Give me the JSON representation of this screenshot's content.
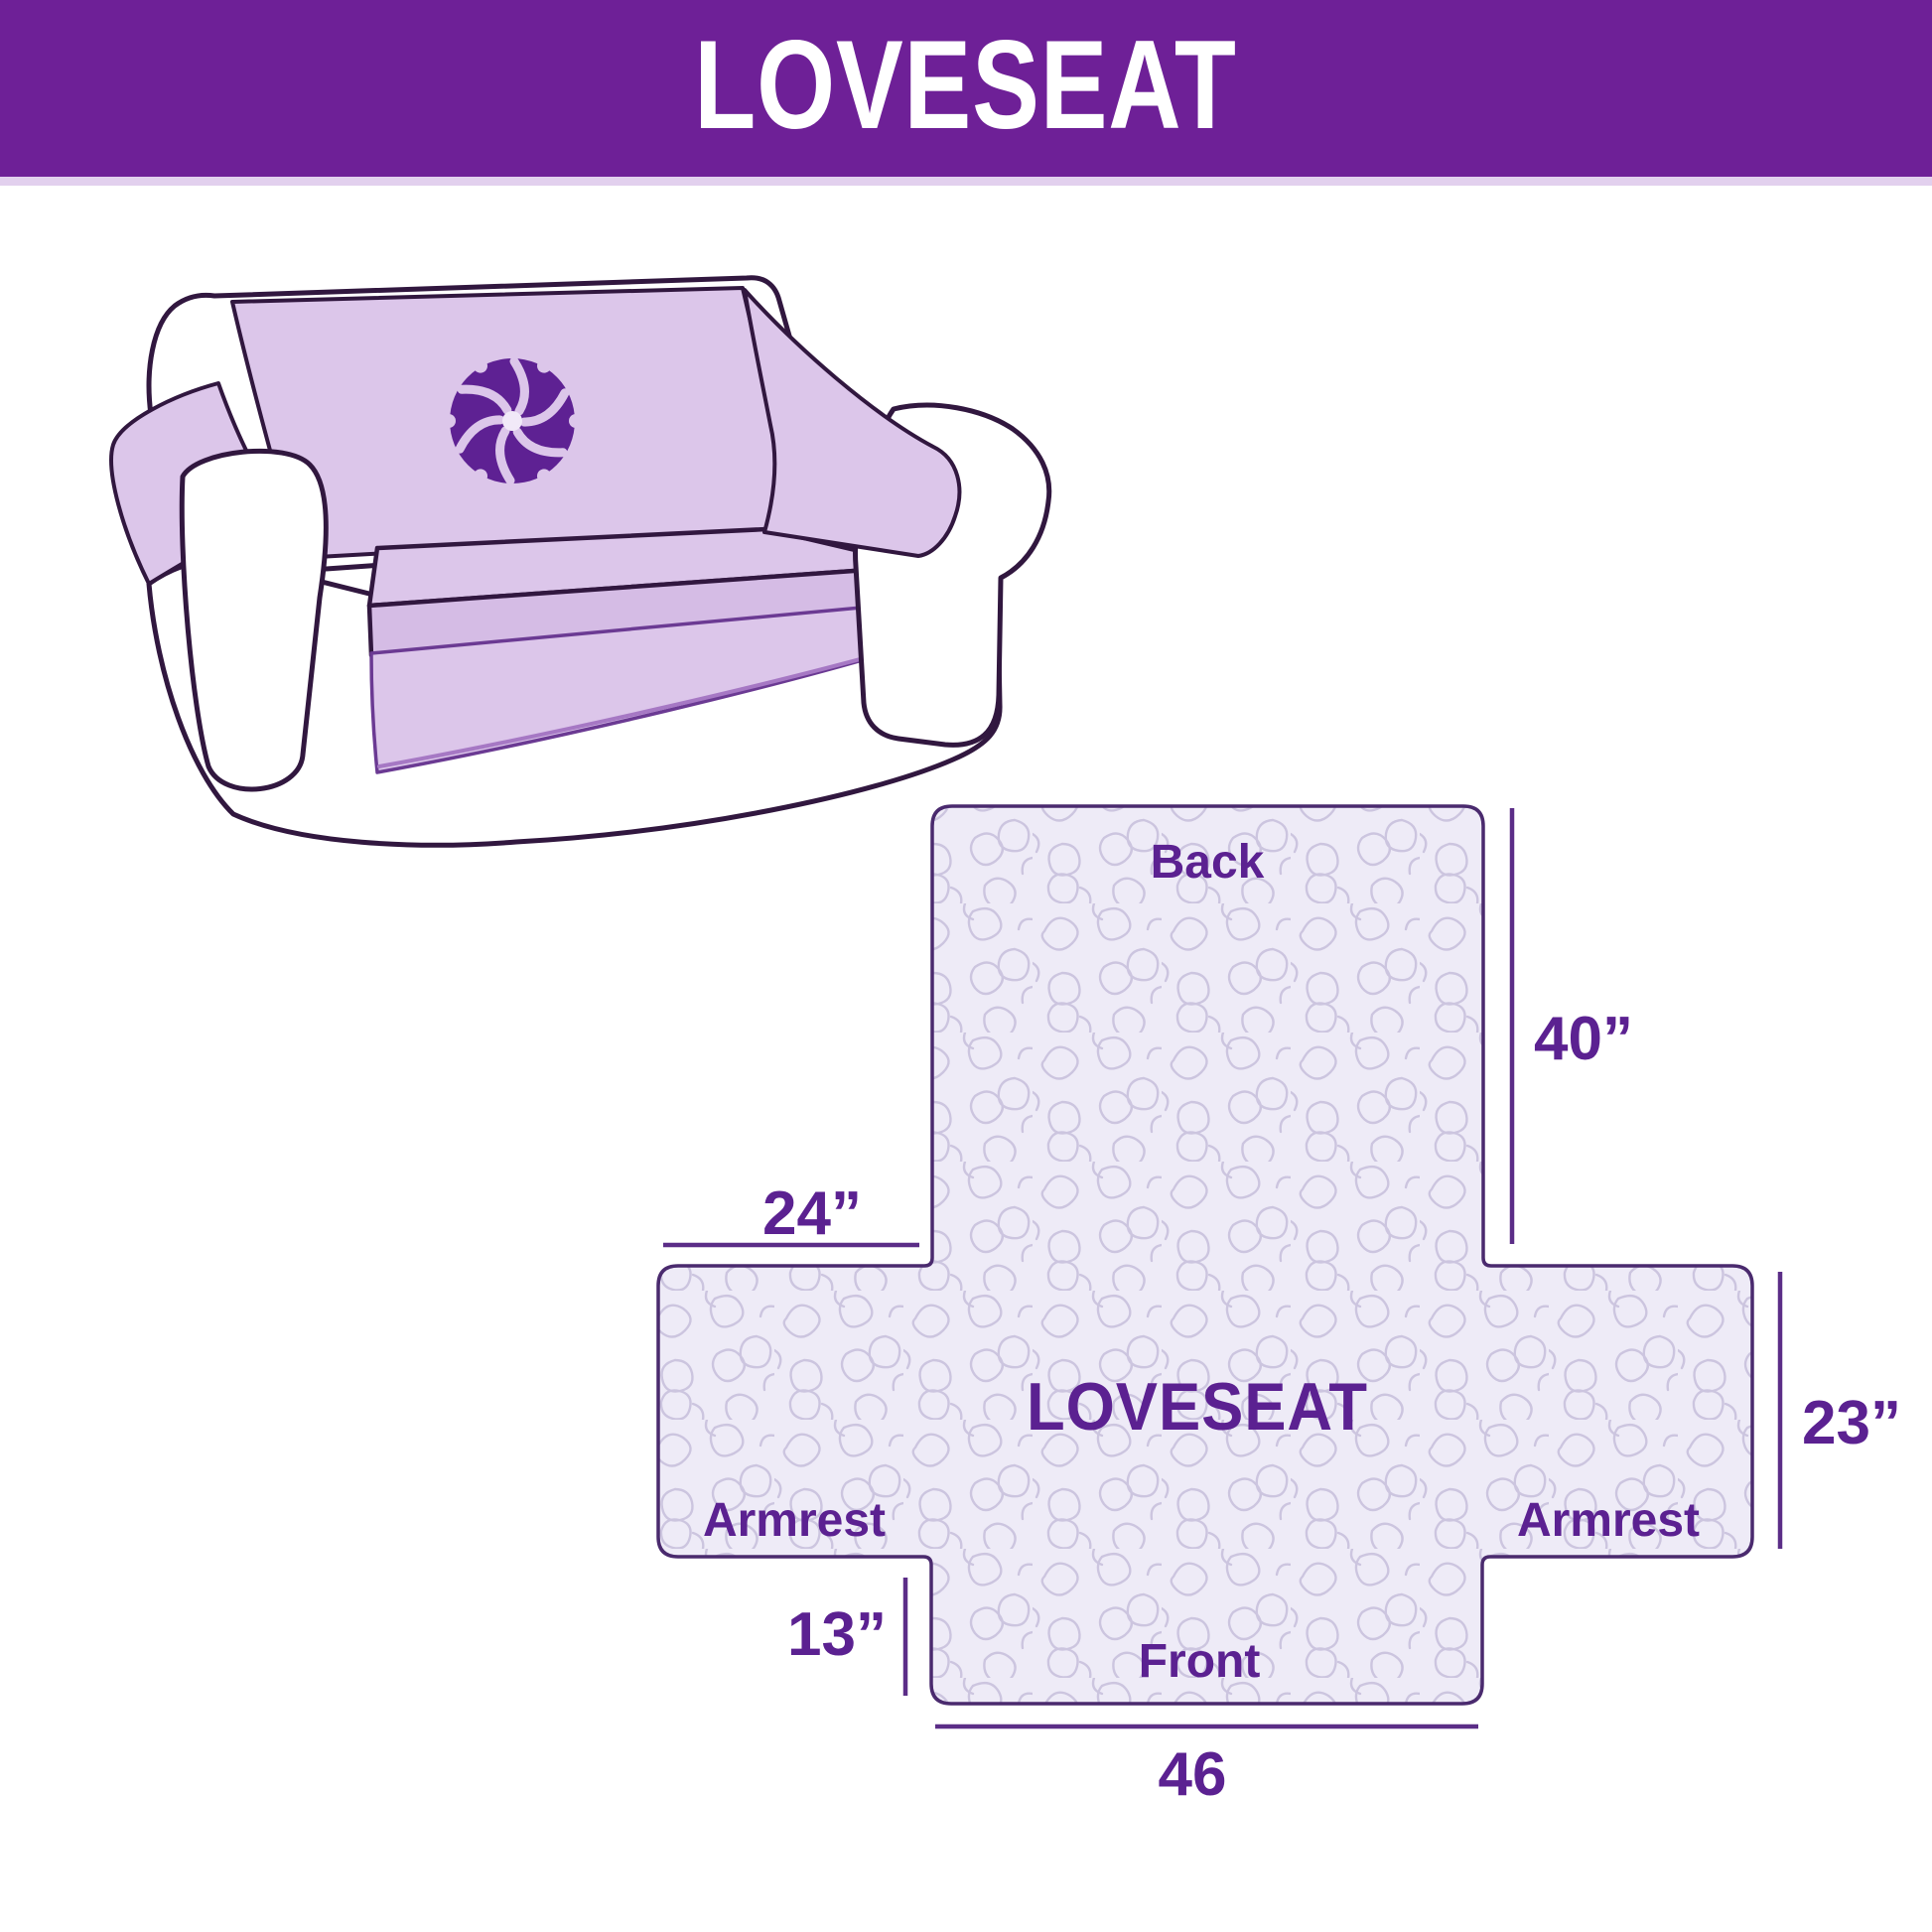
{
  "header": {
    "title": "LOVESEAT",
    "bg_color": "#6e2097",
    "underline_color": "#e2d0ee",
    "text_color": "#ffffff"
  },
  "illustration": {
    "description": "loveseat sofa with lavender protective cover and pinwheel logo",
    "cover_color": "#dcc6ea",
    "outline_color": "#31173f",
    "logo_color": "#5e2193"
  },
  "diagram": {
    "center_label": "LOVESEAT",
    "sections": {
      "back": "Back",
      "front": "Front",
      "armrest_left": "Armrest",
      "armrest_right": "Armrest"
    },
    "dimensions": {
      "back_height": "40”",
      "armrest_top_width": "24”",
      "side_height": "23”",
      "front_height": "13”",
      "front_width": "46"
    },
    "text_color": "#5b2191",
    "line_color": "#5b2d87",
    "fill_color": "#eeebf7",
    "texture_color": "#c9c1dd",
    "outline_color": "#4a2a6e"
  }
}
